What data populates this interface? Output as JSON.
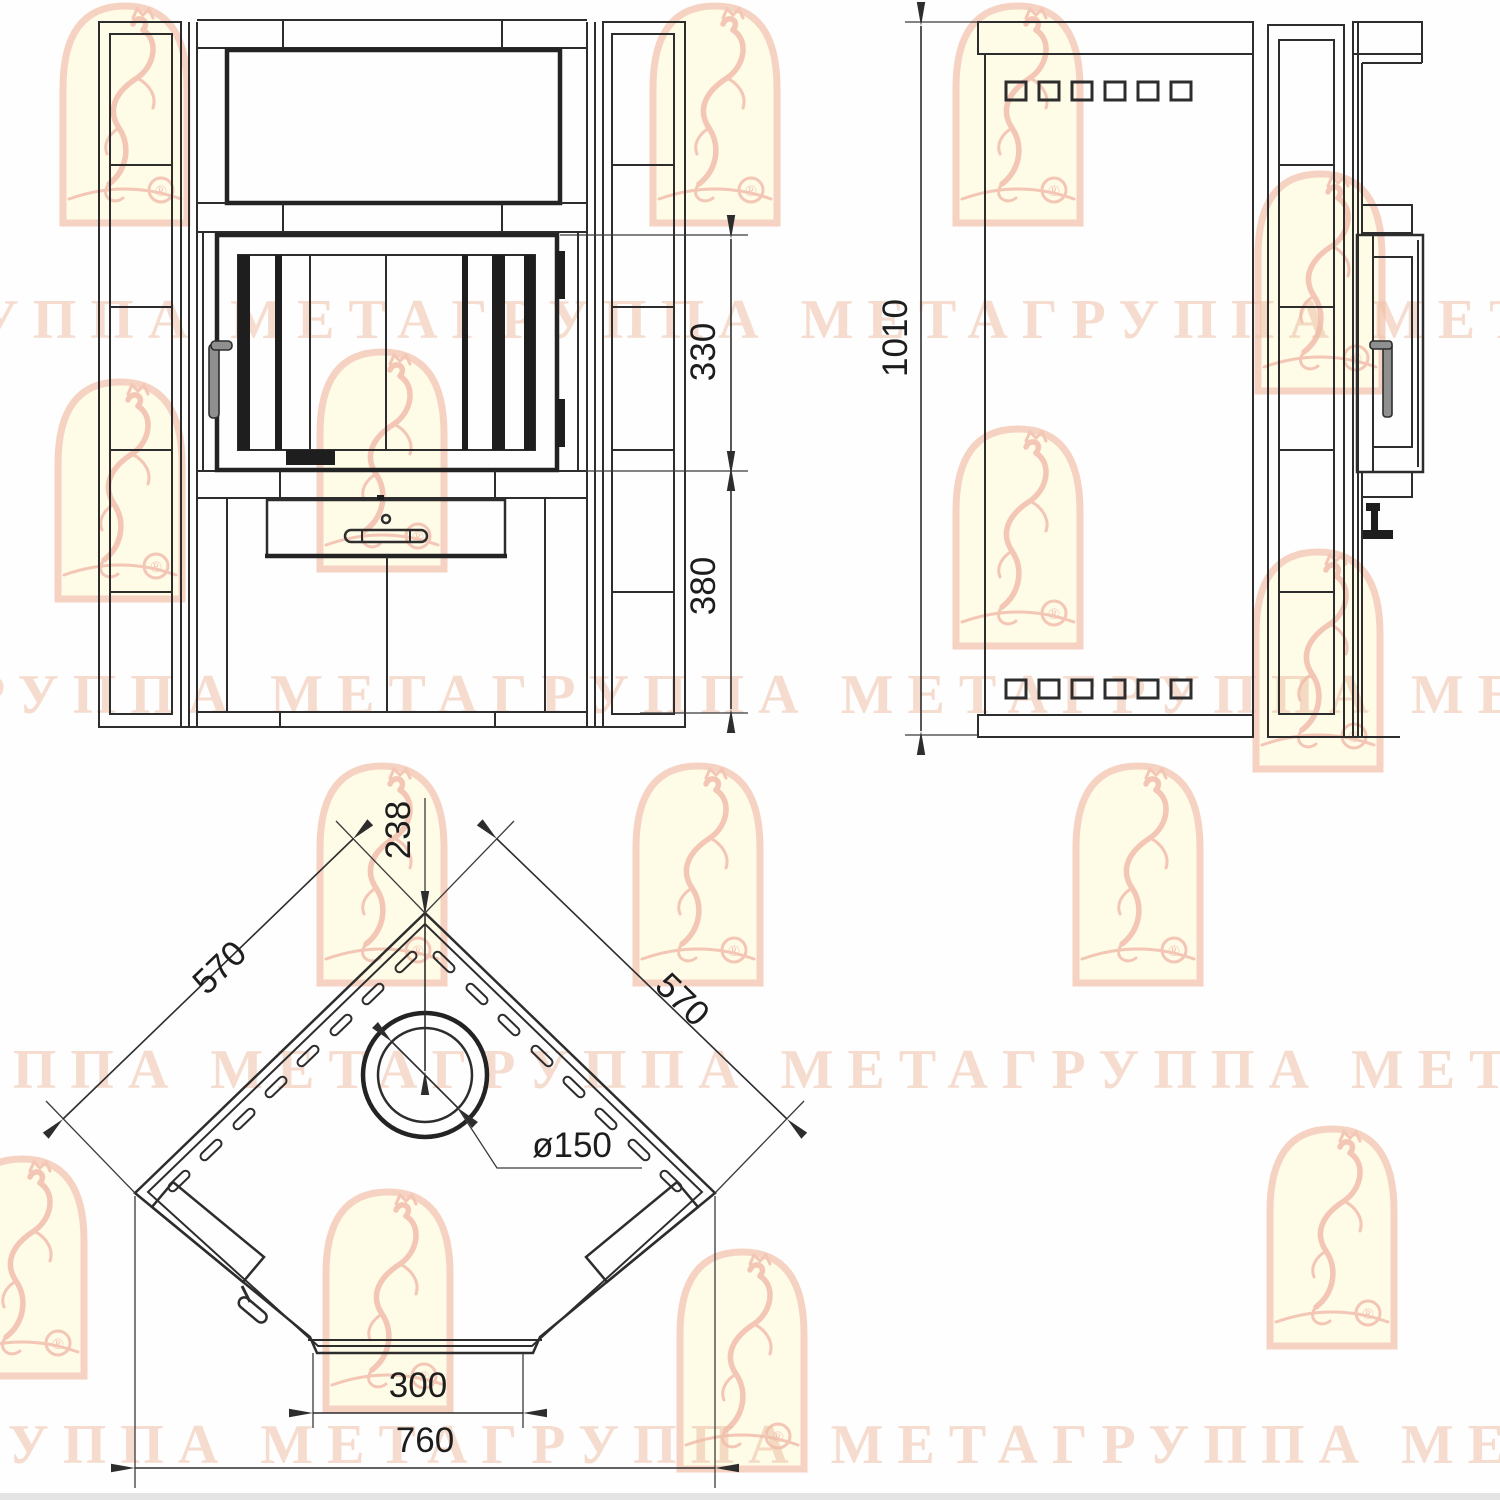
{
  "watermark": {
    "brand_text": "МЕТАГРУППА",
    "registered_mark": "®",
    "text_color": "#edc0a6",
    "logo_border_color": "#f0b49a",
    "logo_fill_color": "#fdf8d8"
  },
  "drawing": {
    "line_color": "#2d2d2d",
    "views": {
      "front": {
        "label": "front-view",
        "dims": {
          "door_height": "330",
          "base_height": "380"
        }
      },
      "side": {
        "label": "side-view",
        "dims": {
          "total_height": "1010"
        }
      },
      "plan": {
        "label": "plan-view",
        "dims": {
          "corner_to_flue_center": "238",
          "left_side": "570",
          "right_side": "570",
          "flue_diameter": "ø150",
          "front_panel_width": "300",
          "overall_width": "760"
        }
      }
    }
  }
}
